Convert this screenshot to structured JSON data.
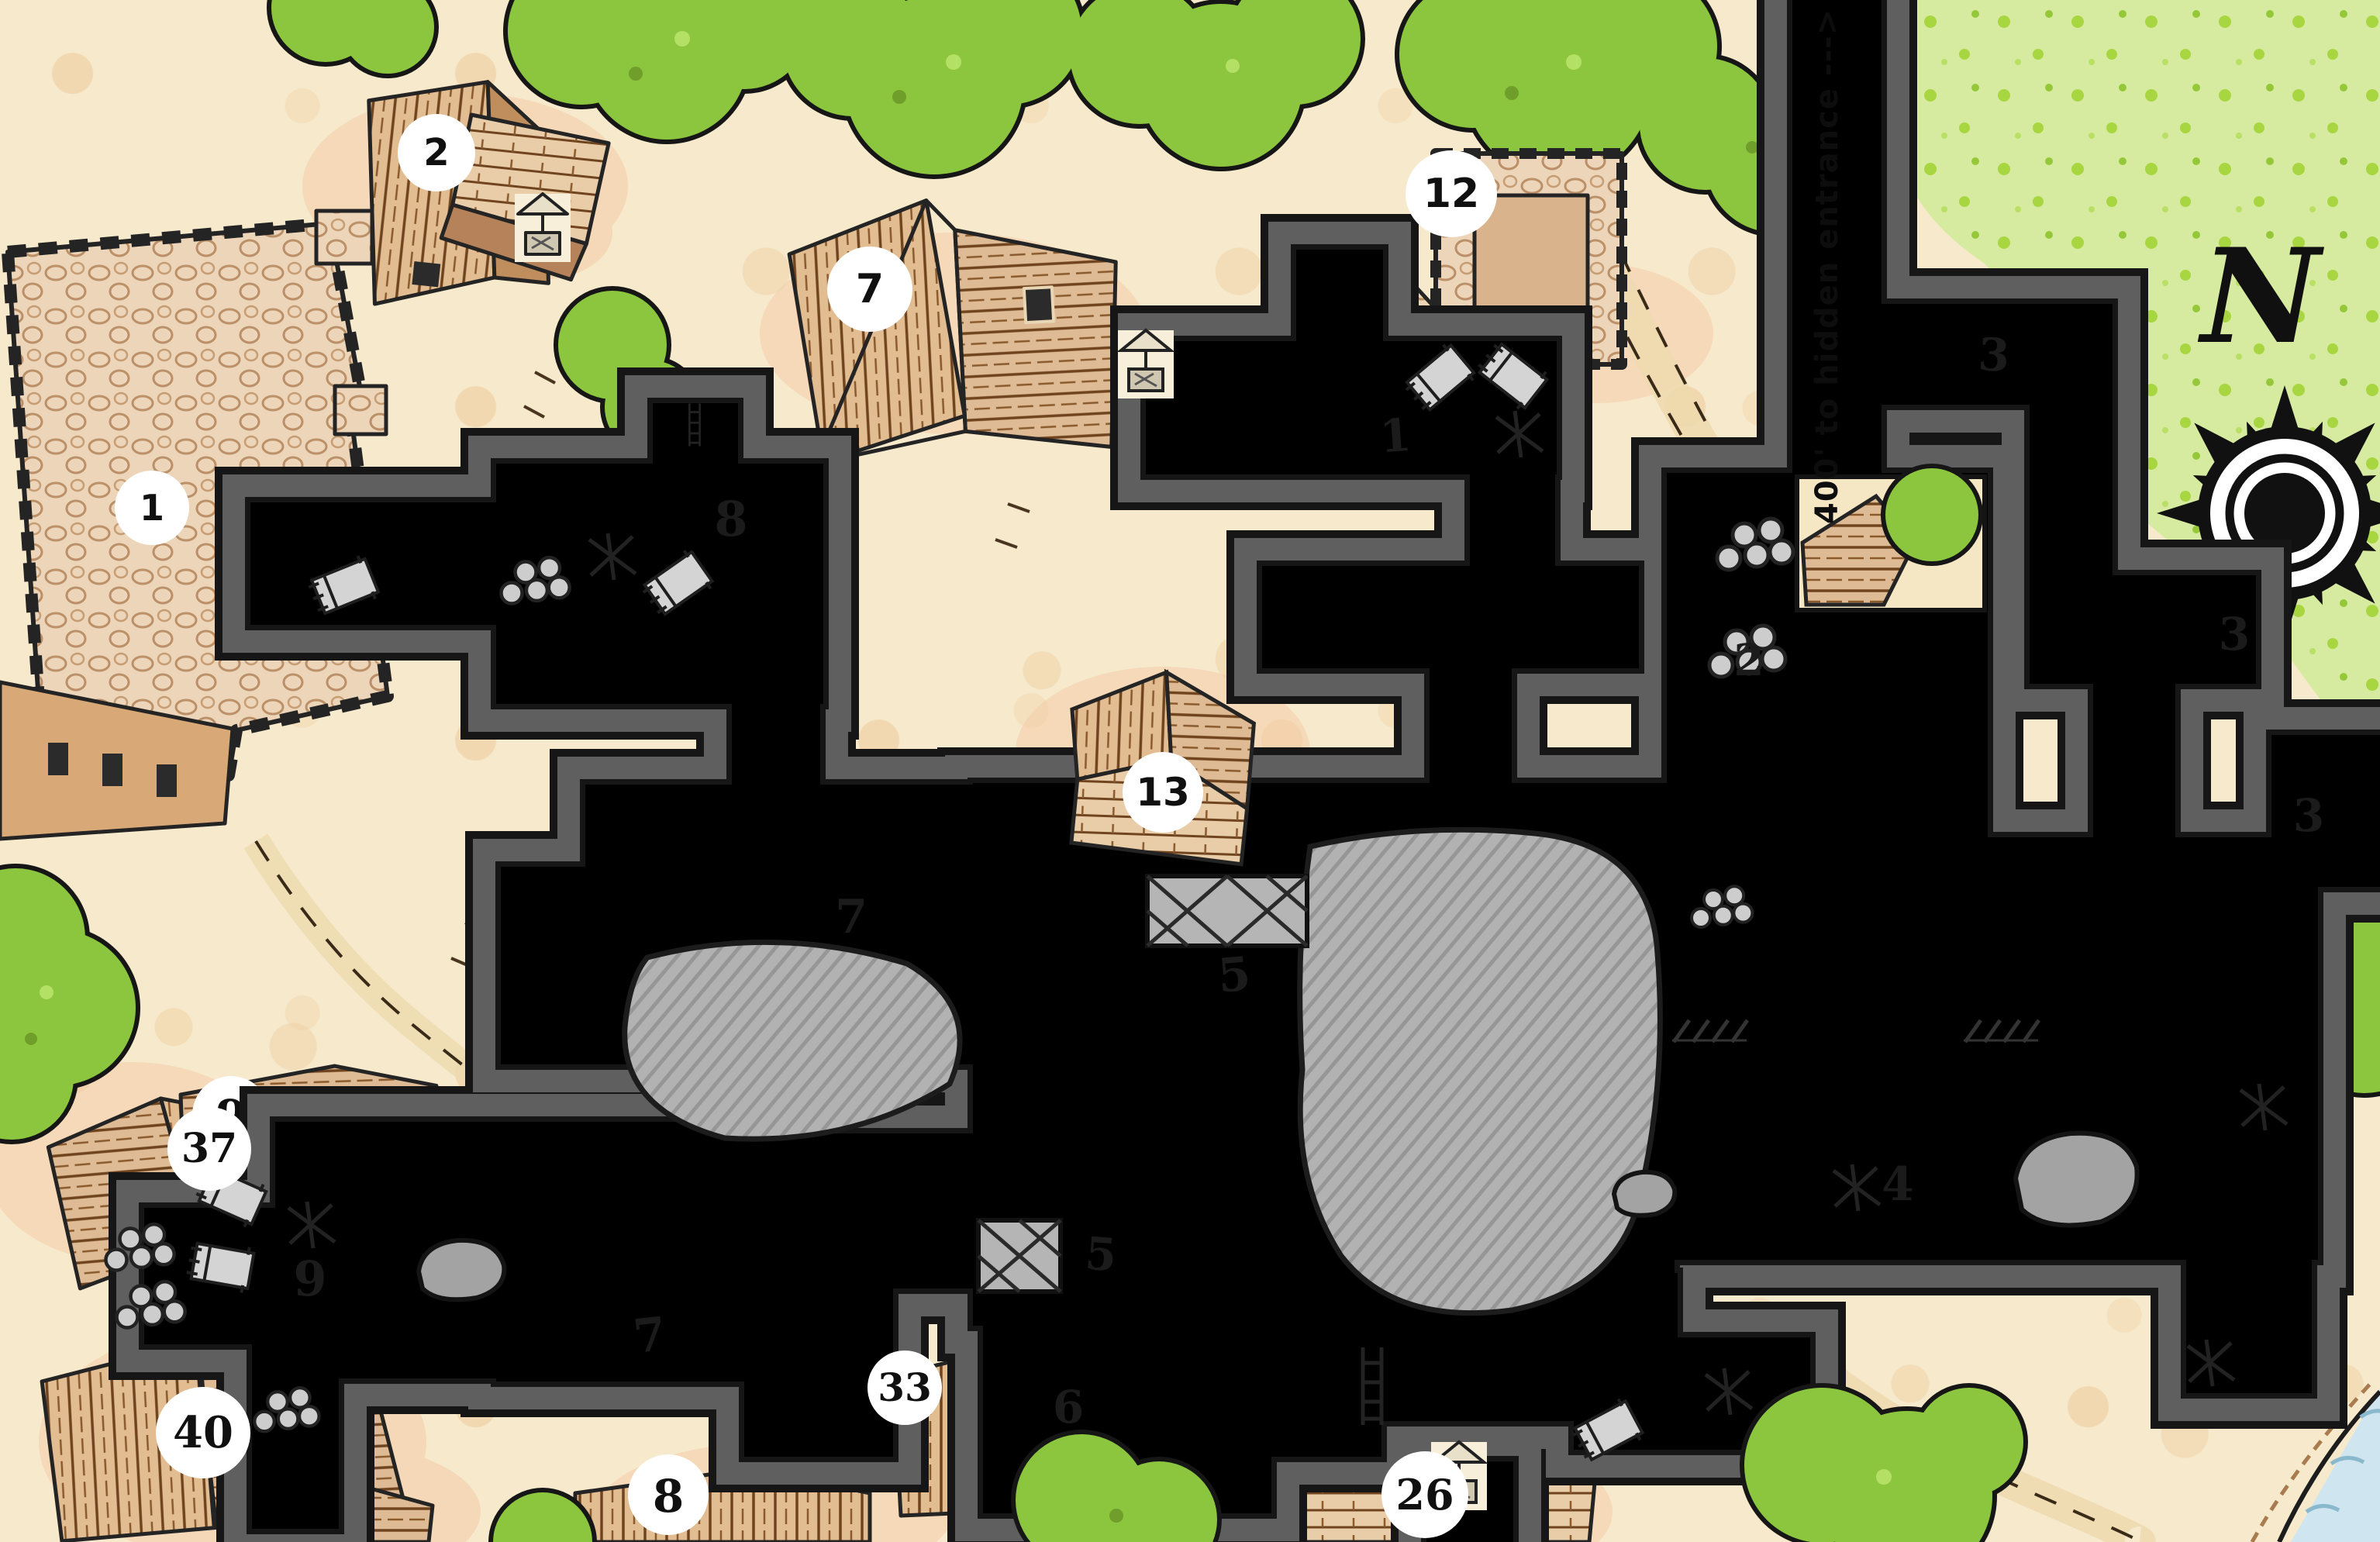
{
  "map": {
    "compass": {
      "letter": "N"
    },
    "annotation": {
      "corridor_note": "400' to hidden entrance --->"
    },
    "village_labels": {
      "manor": "1",
      "house_2": "2",
      "house_7": "7",
      "tower_12": "12",
      "house_13": "13",
      "house_26": "26",
      "house_33": "33",
      "house_37": "37",
      "house_40": "40",
      "partial_top": "9",
      "partial_bottom": "8"
    },
    "dungeon_labels": {
      "room_1": "1",
      "room_2": "2",
      "corridor_3_north": "3",
      "corridor_3_east": "3",
      "room_3_southeast": "3",
      "room_4": "4",
      "trapdoor_5_north": "5",
      "trapdoor_5_south": "5",
      "room_6": "6",
      "hall_7_north": "7",
      "hall_7_south": "7",
      "room_8": "8",
      "room_9": "9"
    },
    "symbols": [
      "compass-rose-icon",
      "well-icon",
      "bed-icon",
      "ladder-icon",
      "barrels-icon",
      "trapdoor-icon",
      "cave-in-icon",
      "boulder-icon",
      "door-threshold-icon",
      "tree-icon"
    ],
    "colors": {
      "parchment": "#f6e9cc",
      "dungeon_floor": "#dcdcdc",
      "dungeon_wall": "#5f5f5f",
      "outline": "#141414",
      "tree_green": "#8cc63e",
      "field_green": "#d6eb9f",
      "roof_tan": "#e3bd92",
      "water": "#cfe6f0"
    }
  }
}
